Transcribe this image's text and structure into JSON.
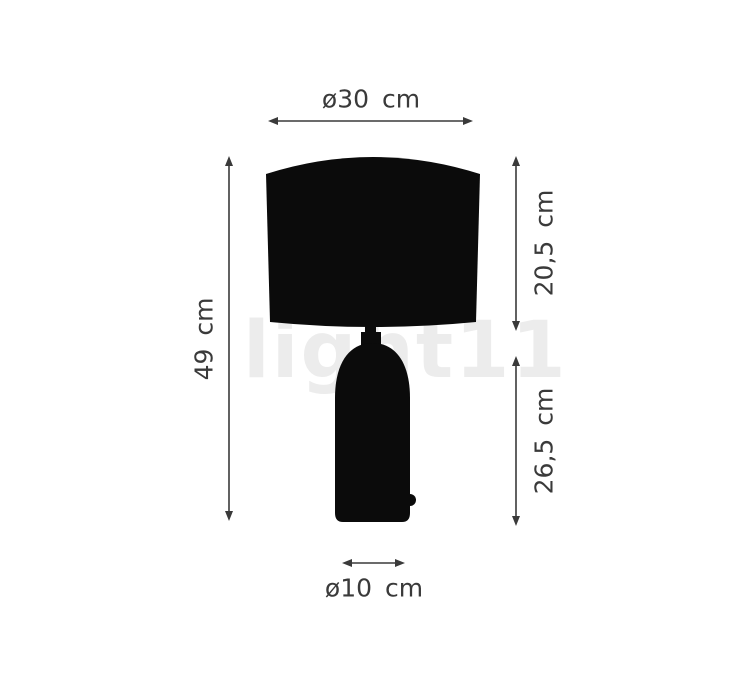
{
  "title": "Table lamp dimension diagram",
  "watermark": {
    "text": "light11"
  },
  "colors": {
    "background": "#ffffff",
    "silhouette": "#0b0b0b",
    "dimension_lines": "#3a3a3a",
    "label_text": "#3a3a3a",
    "watermark": "#ececec"
  },
  "dimensions": {
    "shade_diameter": "ø30 cm",
    "shade_height": "20,5 cm",
    "total_height": "49 cm",
    "base_height": "26,5 cm",
    "base_diameter": "ø10 cm"
  }
}
